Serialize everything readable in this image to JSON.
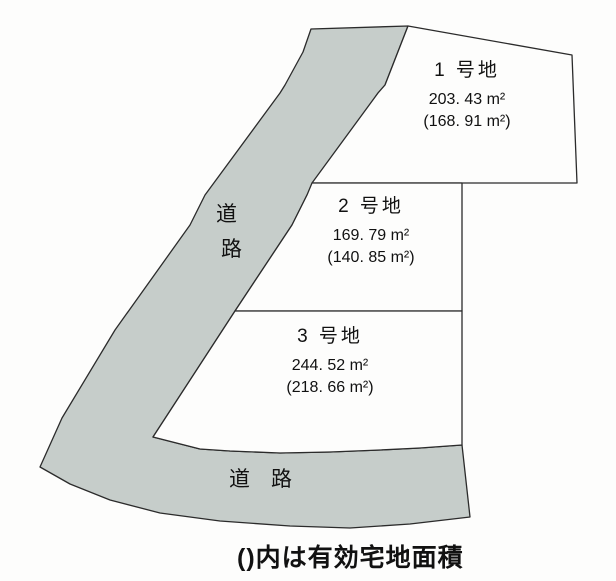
{
  "diagram": {
    "caption": "()内は有効宅地面積",
    "plots": [
      {
        "name": "1 号地",
        "area": "203. 43 m²",
        "effective_area": "(168. 91 m²)"
      },
      {
        "name": "2 号地",
        "area": "169. 79 m²",
        "effective_area": "(140. 85 m²)"
      },
      {
        "name": "3 号地",
        "area": "244. 52 m²",
        "effective_area": "(218. 66 m²)"
      }
    ],
    "roads": {
      "left_vertical_label": [
        "道",
        "路"
      ],
      "bottom_label": "道　路"
    },
    "colors": {
      "road_fill": "#c6cdca",
      "outline": "#2b2b2b",
      "background": "#fdfdfc",
      "text": "#111111"
    }
  }
}
